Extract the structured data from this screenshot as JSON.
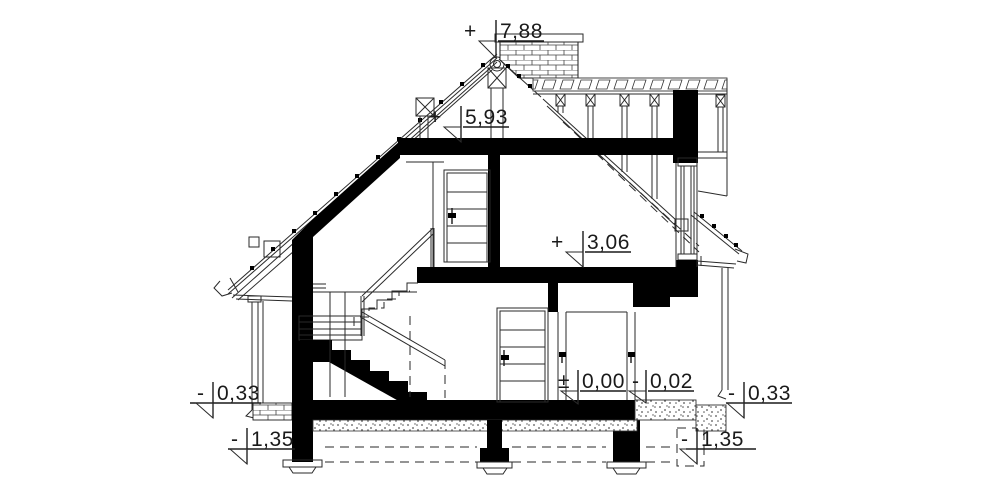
{
  "drawing": {
    "kind": "house cross-section (przekrój)",
    "levels": {
      "ridge": {
        "sign": "+",
        "value": "7,88"
      },
      "attic_ceiling": {
        "sign": "+",
        "value": "5,93"
      },
      "floor_1": {
        "sign": "+",
        "value": "3,06"
      },
      "ground_floor": {
        "sign": "±",
        "value": "0,00"
      },
      "terrace": {
        "sign": "-",
        "value": "0,02"
      },
      "grade_left": {
        "sign": "-",
        "value": "0,33"
      },
      "foundation_left": {
        "sign": "-",
        "value": "1,35"
      },
      "grade_right": {
        "sign": "-",
        "value": "0,33"
      },
      "foundation_right": {
        "sign": "-",
        "value": "1,35"
      }
    },
    "colors": {
      "ink": "#1a1a1a",
      "paper": "#ffffff"
    }
  }
}
